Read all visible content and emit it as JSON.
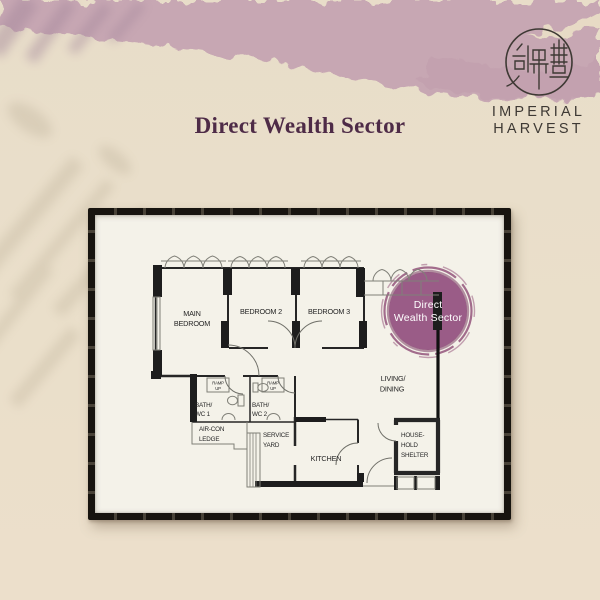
{
  "header": {
    "title": "Direct Wealth Sector"
  },
  "brand": {
    "logo_icon": "imperial-harvest-seal",
    "line1": "IMPERIAL",
    "line2": "HARVEST"
  },
  "floorplan": {
    "highlight": {
      "line1": "Direct",
      "line2": "Wealth Sector",
      "color": "#9a5c87"
    },
    "rooms": {
      "main_bedroom": {
        "line1": "MAIN",
        "line2": "BEDROOM"
      },
      "bedroom2": {
        "label": "BEDROOM 2"
      },
      "bedroom3": {
        "label": "BEDROOM 3"
      },
      "living_dining": {
        "line1": "LIVING/",
        "line2": "DINING"
      },
      "bath1": {
        "line1": "BATH/",
        "line2": "WC 1"
      },
      "bath2": {
        "line1": "BATH/",
        "line2": "WC 2"
      },
      "ramp": {
        "line1": "RAMP",
        "line2": "UP"
      },
      "aircon_ledge": {
        "line1": "AIR-CON",
        "line2": "LEDGE"
      },
      "service_yard": {
        "line1": "SERVICE",
        "line2": "YARD"
      },
      "kitchen": {
        "label": "KITCHEN"
      },
      "household_shelter": {
        "line1": "HOUSE-",
        "line2": "HOLD",
        "line3": "SHELTER"
      }
    }
  },
  "colors": {
    "accent_purple": "#9a5c87",
    "title_plum": "#4e2b47",
    "background_pink": "#c7a7b3",
    "background_cream": "#e9dec9",
    "frame_black": "#17140f",
    "paper": "#f4f2e9"
  }
}
